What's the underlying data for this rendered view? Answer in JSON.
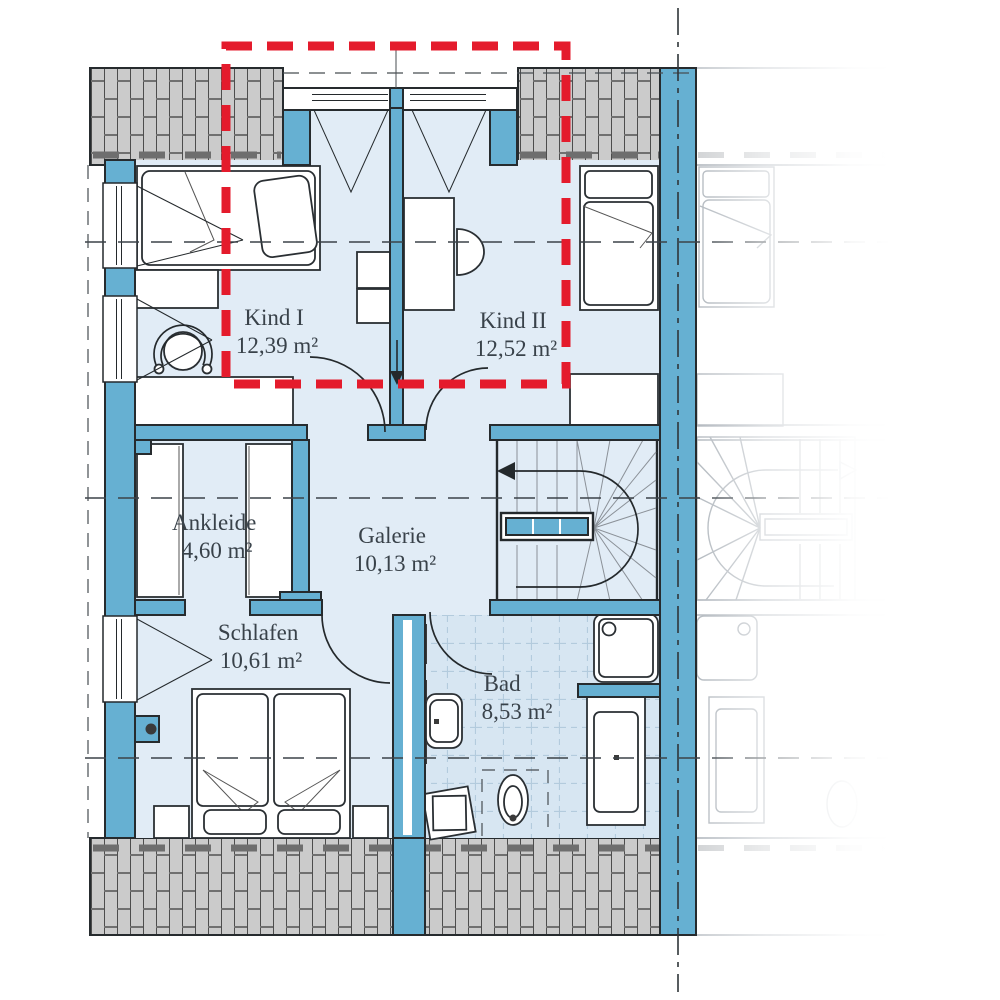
{
  "plan": {
    "rooms": [
      {
        "id": "kind1",
        "name": "Kind I",
        "area": "12,39 m²"
      },
      {
        "id": "kind2",
        "name": "Kind II",
        "area": "12,52 m²"
      },
      {
        "id": "ankleide",
        "name": "Ankleide",
        "area": "4,60 m²"
      },
      {
        "id": "galerie",
        "name": "Galerie",
        "area": "10,13 m²"
      },
      {
        "id": "schlafen",
        "name": "Schlafen",
        "area": "10,61 m²"
      },
      {
        "id": "bad",
        "name": "Bad",
        "area": "8,53 m²"
      }
    ],
    "annotations": {
      "highlight_box_rooms": "Kind I, Kind II",
      "mirror_axis": "party wall center line of semi-detached house",
      "neighbor_unit": "mirrored twin unit shown faded"
    },
    "colors": {
      "wall": "#66b0d2",
      "room_fill": "#e1ecf6",
      "bath_tile": "#d7e6f2",
      "roof_fill": "#cbcbcb",
      "roof_line": "#4d4d4d",
      "outline": "#262b2e",
      "highlight_red": "#e41b2c",
      "ghost_line": "#b4bac0",
      "text": "#39424a"
    }
  }
}
